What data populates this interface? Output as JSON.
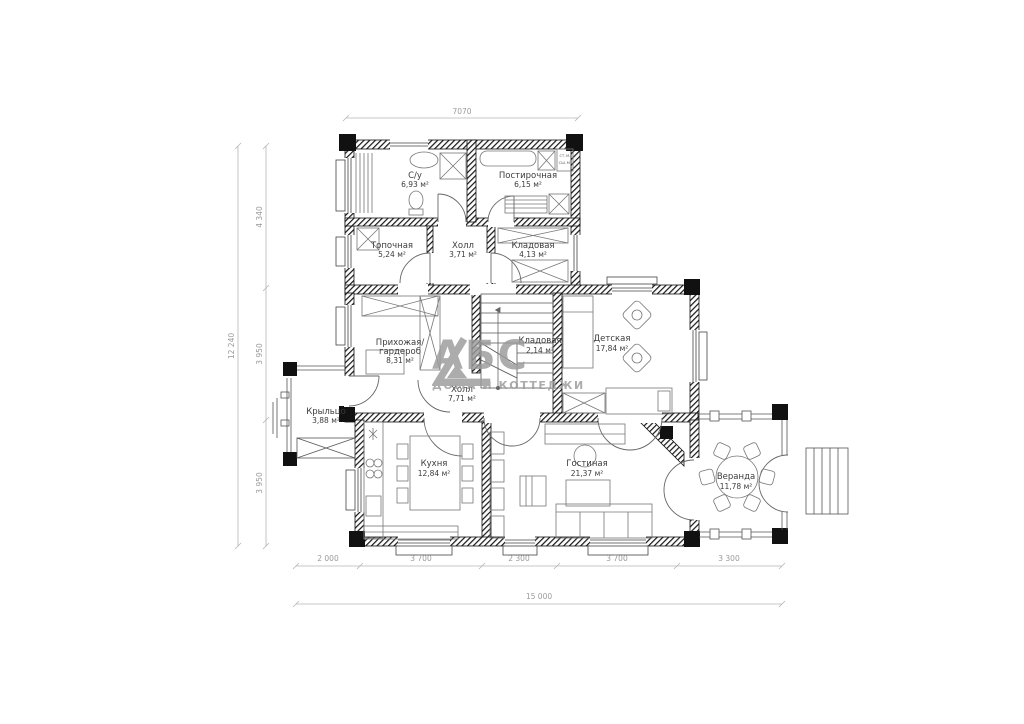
{
  "watermark": {
    "brand": "АБС",
    "tagline": "ДОМА И КОТТЕДЖИ"
  },
  "rooms": {
    "su": {
      "name": "С/у",
      "area": "6,93 м²"
    },
    "laundry": {
      "name": "Постирочная",
      "area": "6,15 м²"
    },
    "boiler": {
      "name": "Топочная",
      "area": "5,24 м²"
    },
    "hall_top": {
      "name": "Холл",
      "area": "3,71 м²"
    },
    "storage": {
      "name": "Кладовая",
      "area": "4,13 м²"
    },
    "entry": {
      "line1": "Прихожая/",
      "line2": "гардероб",
      "area": "8,31 м²"
    },
    "stair_storage": {
      "name": "Кладовая",
      "area": "2,14 м²"
    },
    "kids": {
      "name": "Детская",
      "area": "17,84 м²"
    },
    "hall_mid": {
      "name": "Холл",
      "area": "7,71 м²"
    },
    "porch": {
      "name": "Крыльцо",
      "area": "3,88 м²"
    },
    "kitchen": {
      "name": "Кухня",
      "area": "12,84 м²"
    },
    "living": {
      "name": "Гостиная",
      "area": "21,37 м²"
    },
    "veranda": {
      "name": "Веранда",
      "area": "11,78 м²"
    }
  },
  "appliances": {
    "washer": "ст.м.",
    "dryer": "сш.м."
  },
  "dimensions": {
    "top_width": "7070",
    "left_total": "12 240",
    "left_segments": [
      "4 340",
      "3 950",
      "3 950"
    ],
    "bottom_segments": [
      "2 000",
      "3 700",
      "2 300",
      "3 700",
      "3 300"
    ],
    "bottom_total": "15 000"
  }
}
